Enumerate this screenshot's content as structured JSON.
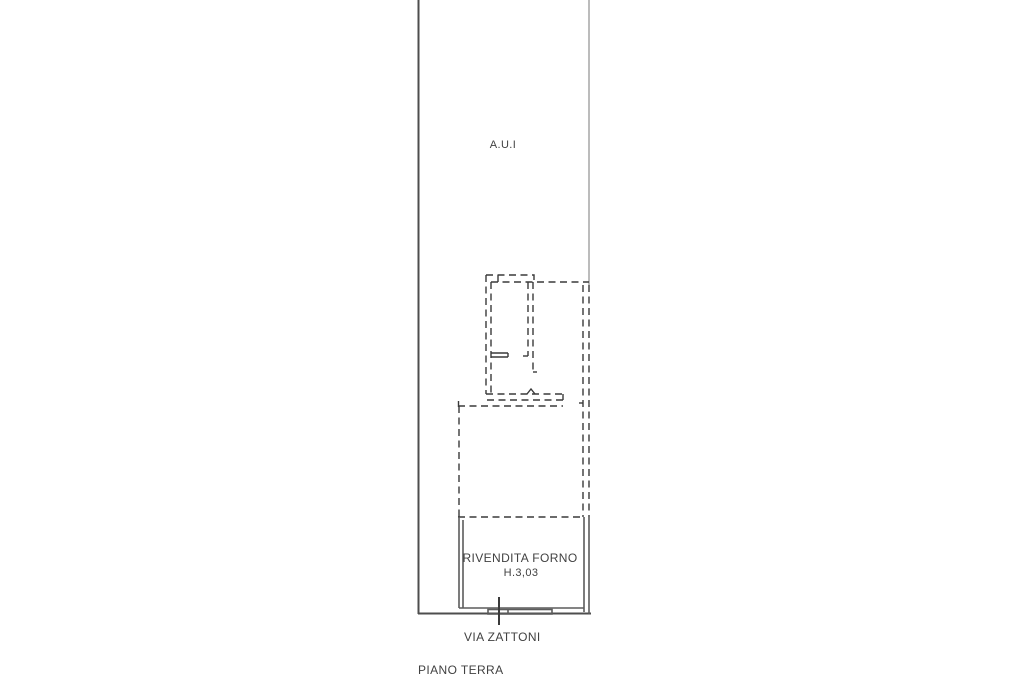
{
  "labels": {
    "area": "A.U.I",
    "room_name": "RIVENDITA FORNO",
    "room_height": "H.3,03",
    "street": "VIA ZATTONI",
    "floor": "PIANO TERRA"
  },
  "colors": {
    "background": "#ffffff",
    "solid_line_dark": "#4d4d4d",
    "solid_line_light": "#ababab",
    "dashed_line": "#3a3a3a",
    "wall_line": "#5c5c5c",
    "text": "#414141"
  }
}
